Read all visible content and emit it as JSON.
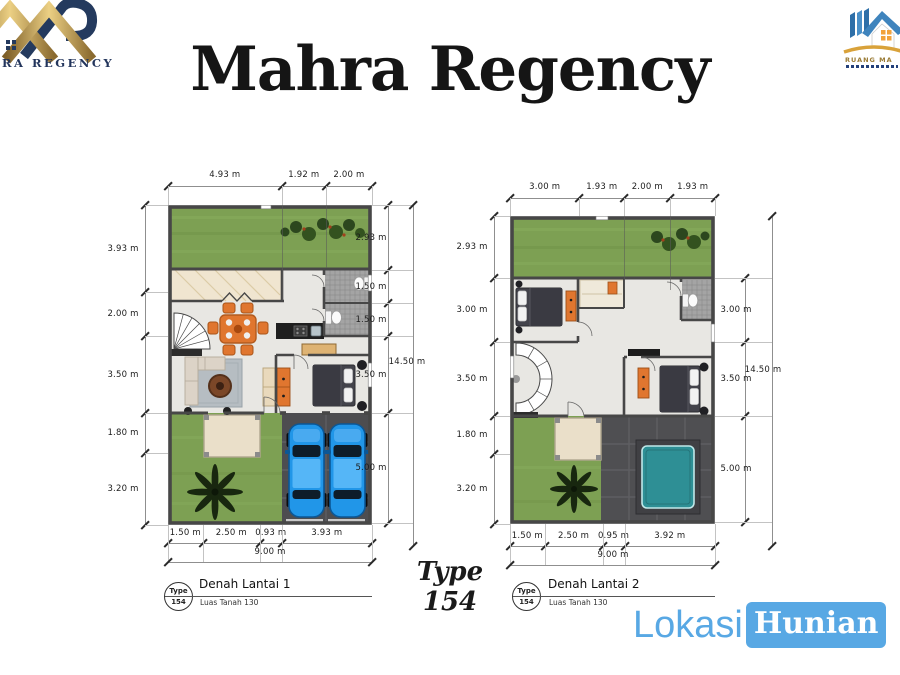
{
  "header": {
    "title": "Mahra Regency"
  },
  "logos": {
    "left": {
      "text": "RA REGENCY"
    },
    "right": {
      "text": "RUANG MA"
    }
  },
  "plans": [
    {
      "badge": {
        "top": "Type",
        "bottom": "154"
      },
      "title": "Denah Lantai 1",
      "subtitle": "Luas Tanah 130",
      "dims_top": [
        "4.93 m",
        "1.92 m",
        "2.00 m"
      ],
      "dims_left": [
        "3.93 m",
        "2.00 m",
        "3.50 m",
        "1.80 m",
        "3.20 m"
      ],
      "dims_right": [
        "2.93 m",
        "1.50 m",
        "1.50 m",
        "3.50 m",
        "5.00 m"
      ],
      "dim_right_total": "14.50 m",
      "dims_bottom": [
        "1.50 m",
        "2.50 m",
        "0.93 m",
        "3.93 m"
      ],
      "dim_bottom_total": "9.00 m"
    },
    {
      "badge": {
        "top": "Type",
        "bottom": "154"
      },
      "title": "Denah Lantai 2",
      "subtitle": "Luas Tanah 130",
      "dims_top": [
        "3.00 m",
        "1.93 m",
        "2.00 m",
        "1.93 m"
      ],
      "dims_left": [
        "2.93 m",
        "3.00 m",
        "3.50 m",
        "1.80 m",
        "3.20 m"
      ],
      "dims_right": [
        "3.00 m",
        "3.50 m",
        "5.00 m"
      ],
      "dim_right_total": "14.50 m",
      "dims_bottom": [
        "1.50 m",
        "2.50 m",
        "0.95 m",
        "3.92 m"
      ],
      "dim_bottom_total": "9.00 m"
    }
  ],
  "type_block": {
    "line1": "Type",
    "line2": "154"
  },
  "watermark": {
    "lokasi": "Lokasi",
    "hunian": "Hunian"
  },
  "colors": {
    "watermark_blue": "#58a8e4",
    "grass_green": "#7da053",
    "carport_gray": "#4d4d50",
    "car_blue": "#2196e8",
    "pool_teal": "#2e8f95",
    "accent_orange": "#e0762f",
    "logo_navy": "#23355c",
    "logo_gold": "#c9a14a"
  }
}
